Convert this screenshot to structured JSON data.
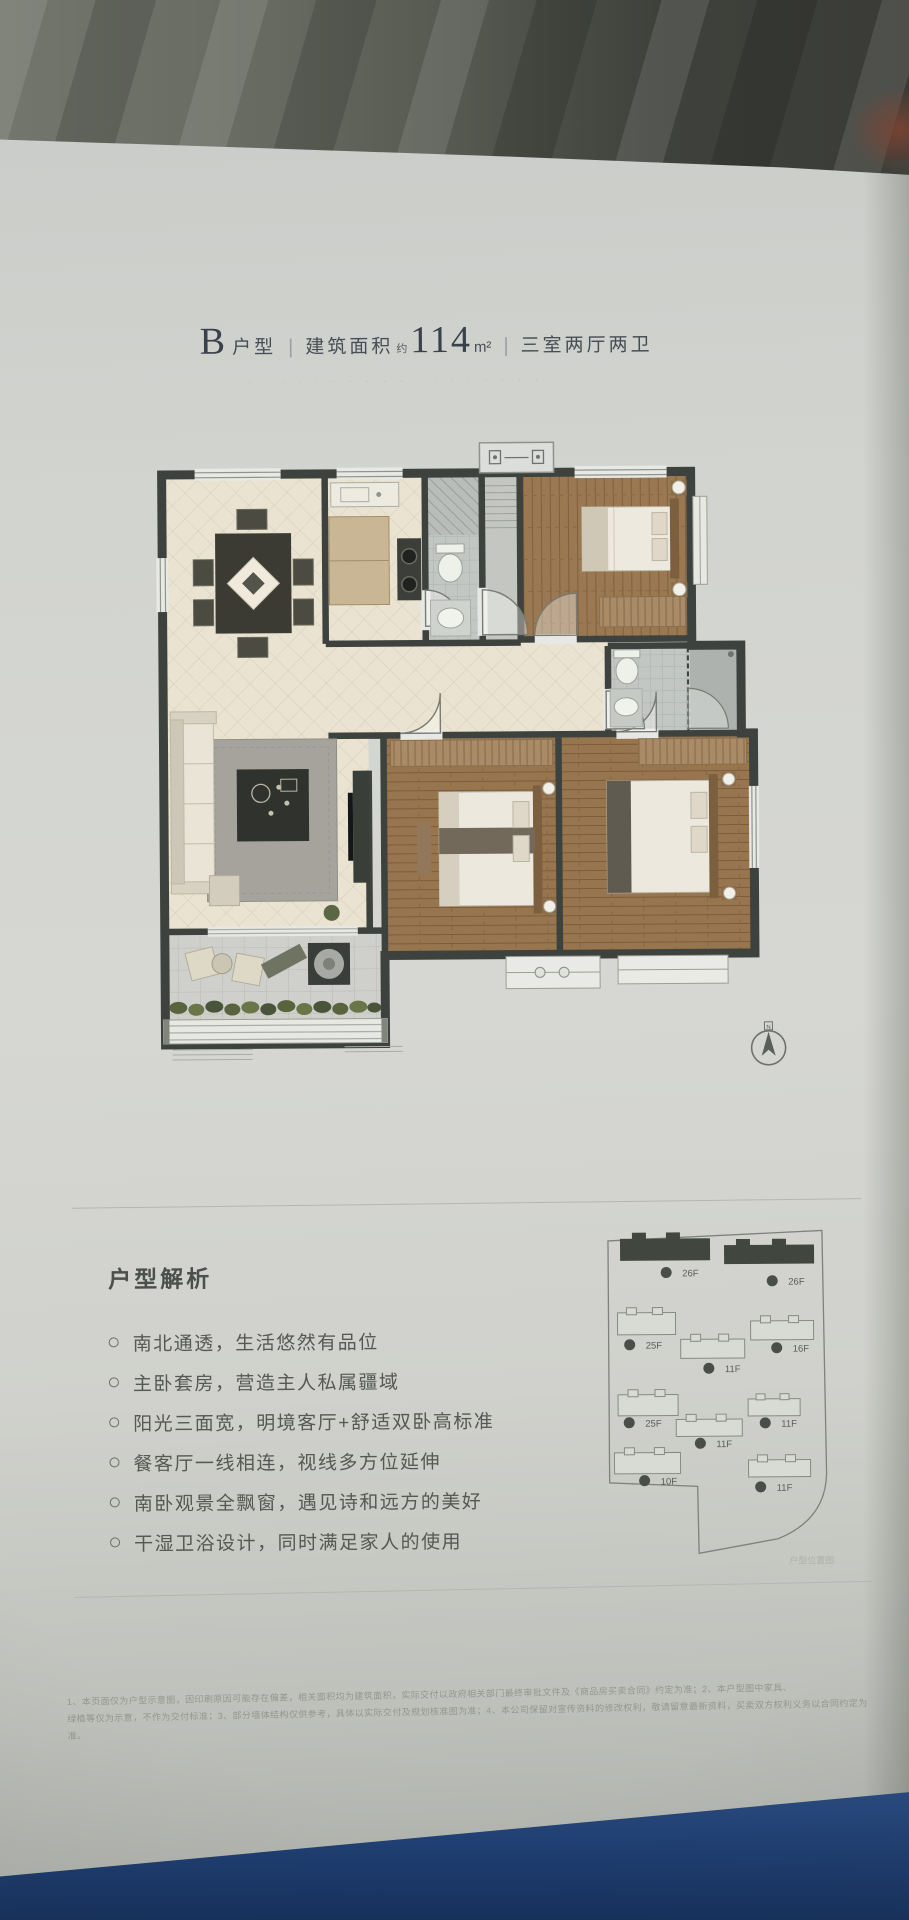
{
  "header": {
    "unit_letter": "B",
    "unit_label": "户型",
    "sep": "|",
    "area_label": "建筑面积",
    "area_approx": "约",
    "area_value": "114",
    "area_unit": "m²",
    "layout_text": "三室两厅两卫",
    "watermark": "· · · · · · · · · · · · · · · · · ·"
  },
  "analysis": {
    "heading": "户型解析",
    "bullets": [
      "南北通透，生活悠然有品位",
      "主卧套房，营造主人私属疆域",
      "阳光三面宽，明境客厅+舒适双卧高标准",
      "餐客厅一线相连，视线多方位延伸",
      "南卧观景全飘窗，遇见诗和远方的美好",
      "干湿卫浴设计，同时满足家人的使用"
    ]
  },
  "site_plan": {
    "caption": "户型位置图",
    "buildings": [
      {
        "floors": "26F",
        "highlighted": true
      },
      {
        "floors": "26F",
        "highlighted": true
      },
      {
        "floors": "25F",
        "highlighted": false
      },
      {
        "floors": "16F",
        "highlighted": false
      },
      {
        "floors": "11F",
        "highlighted": false
      },
      {
        "floors": "25F",
        "highlighted": false
      },
      {
        "floors": "11F",
        "highlighted": false
      },
      {
        "floors": "11F",
        "highlighted": false
      },
      {
        "floors": "10F",
        "highlighted": false
      },
      {
        "floors": "11F",
        "highlighted": false
      }
    ]
  },
  "compass": {
    "label": "N"
  },
  "disclaimer": {
    "line1": "1、本页面仅为户型示意图，因印刷原因可能存在偏差，相关面积均为建筑面积，实际交付以政府相关部门最终审批文件及《商品房买卖合同》约定为准；2、本户型图中家具、",
    "line2": "绿植等仅为示意，不作为交付标准；3、部分墙体结构仅供参考，具体以实际交付及规划核准图为准；4、本公司保留对宣传资料的修改权利，敬请留意最新资料，买卖双方权利义务以合同约定为准。"
  },
  "colors": {
    "accent_blue": "#1d3c6e",
    "wall": "#3e423e",
    "wood": "#97764f",
    "tile": "#eae3d2"
  }
}
